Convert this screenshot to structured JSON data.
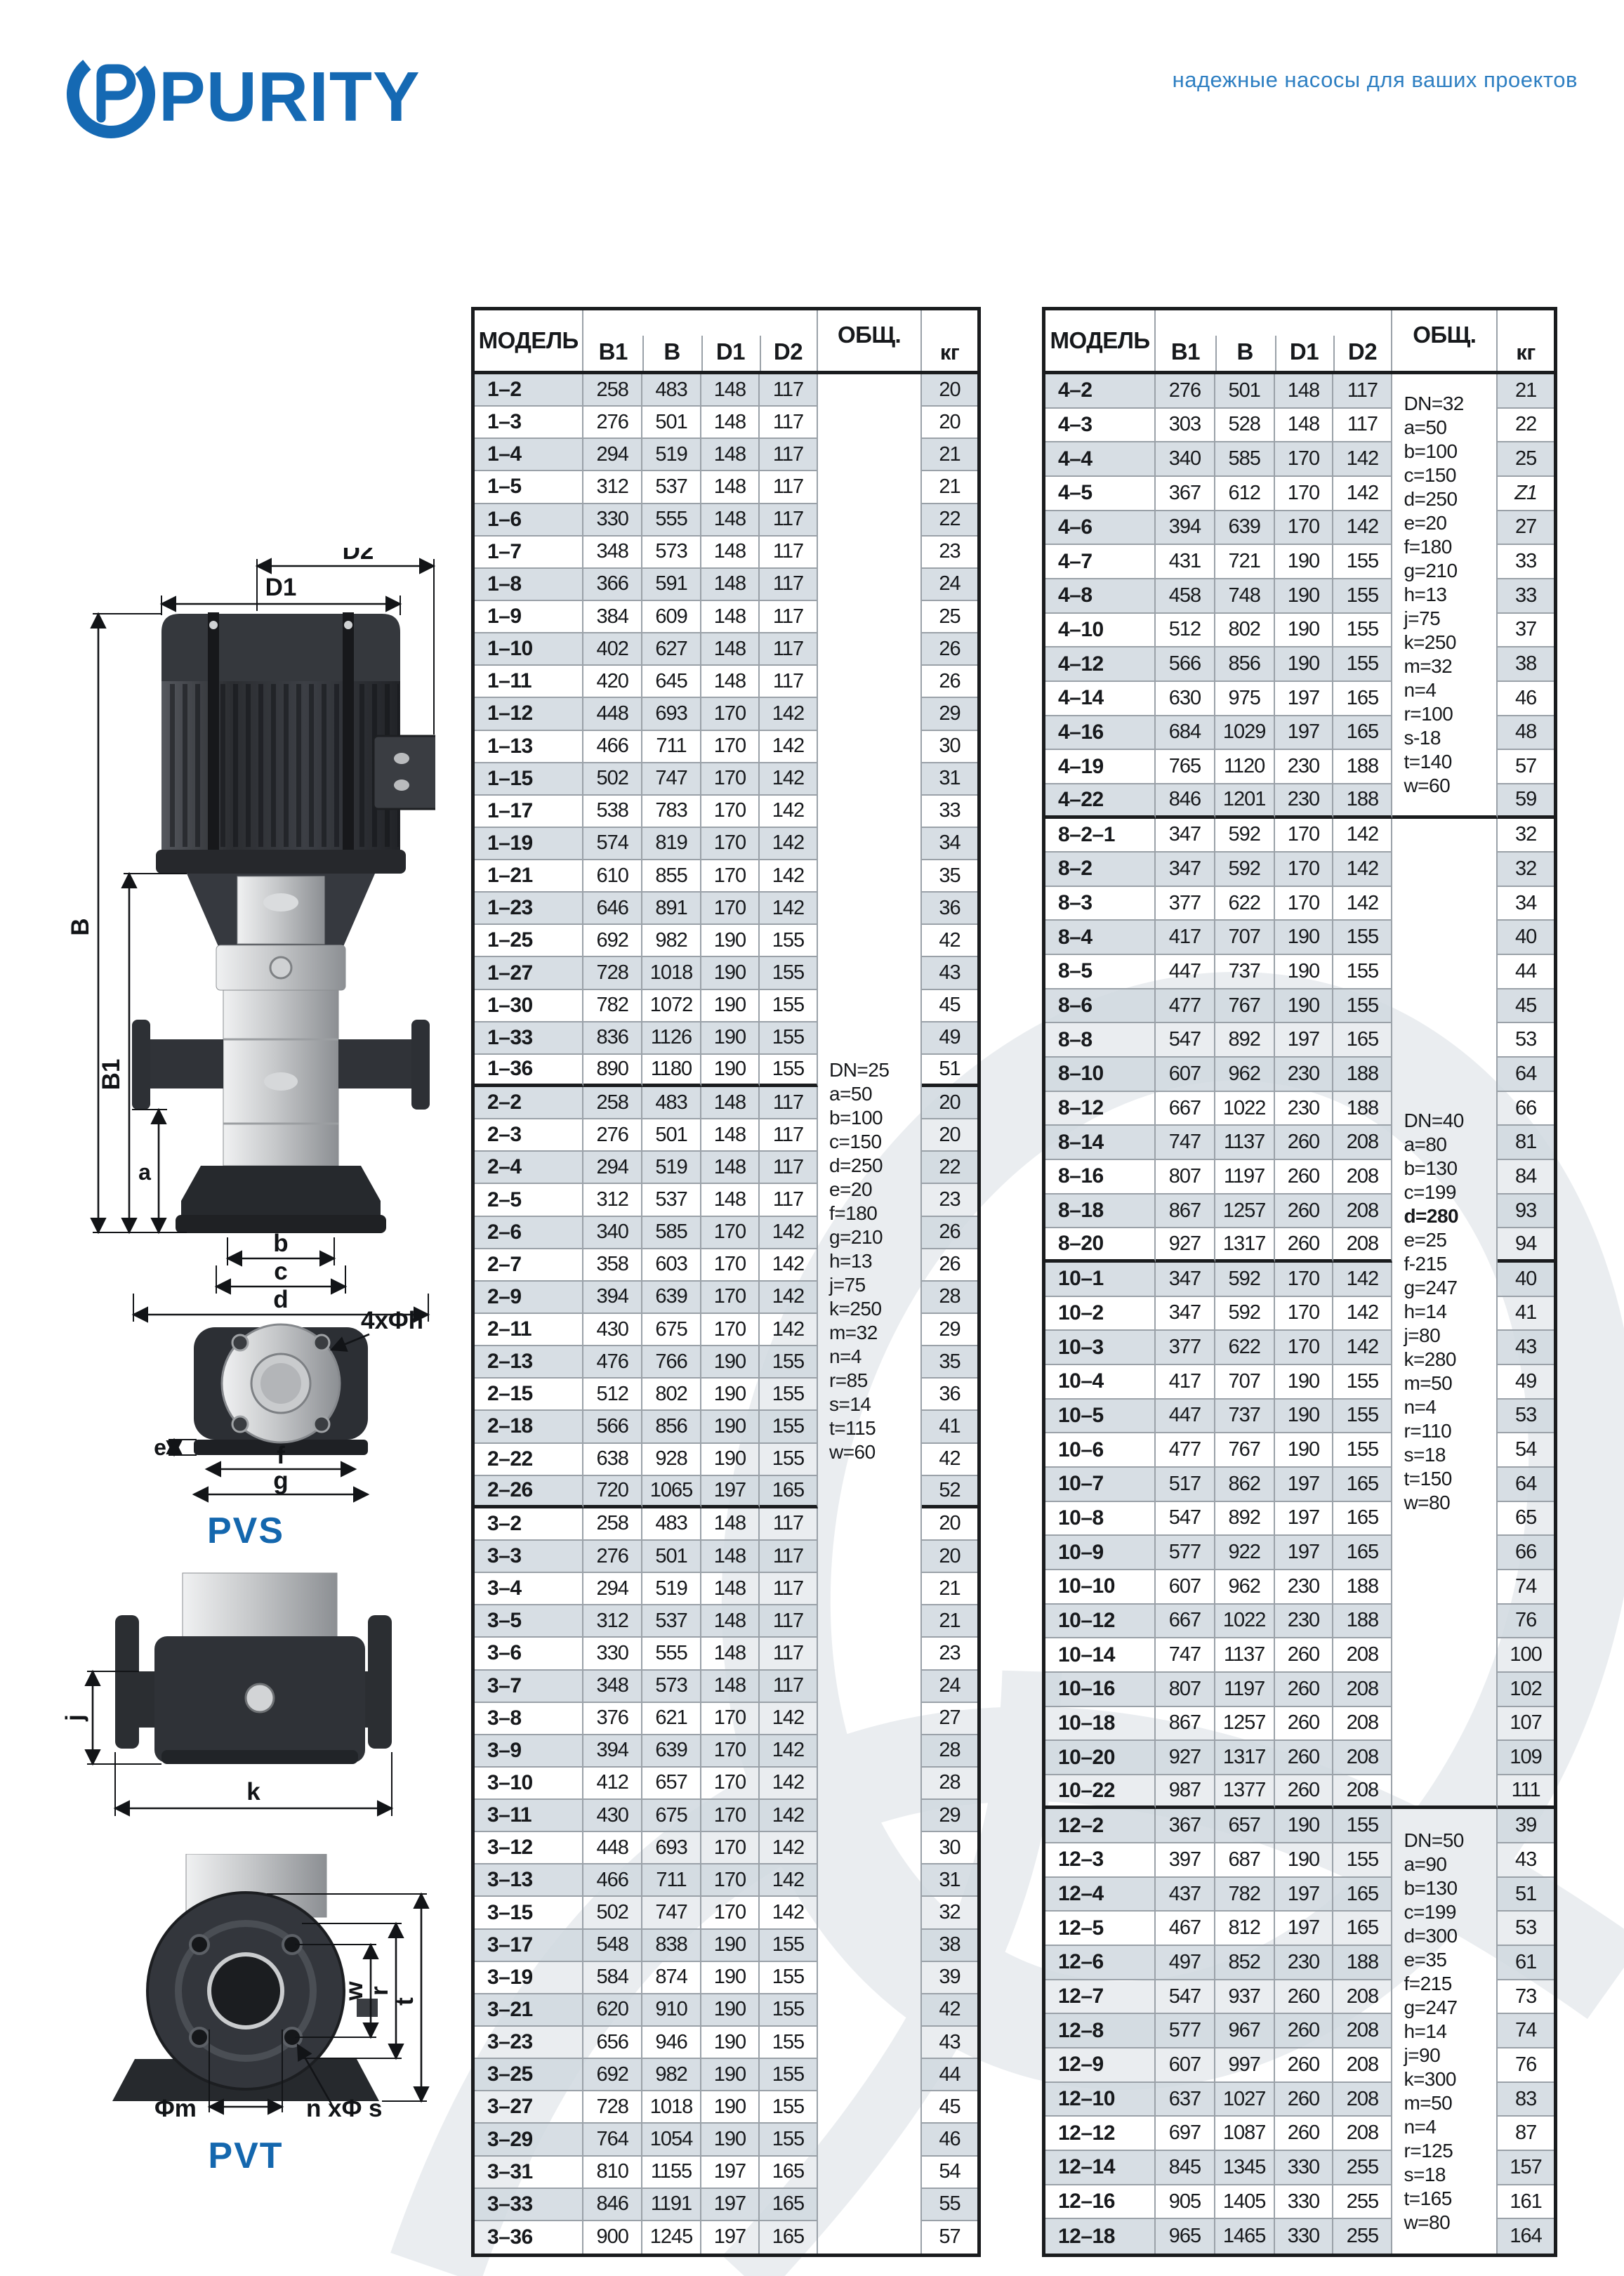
{
  "brand": {
    "logo_text": "PURITY",
    "tagline": "надежные насосы для ваших проектов",
    "blue": "#1569b3",
    "tagline_blue": "#2e7fc2"
  },
  "diagrams": {
    "pvs_label": "PVS",
    "pvt_label": "PVT",
    "dims": {
      "d1": "D1",
      "d2": "D2",
      "b_cap": "B",
      "b1": "B1",
      "a": "a",
      "b": "b",
      "c": "c",
      "d": "d",
      "e": "e",
      "f": "f",
      "g": "g",
      "holes": "4xΦh",
      "j": "j",
      "k": "k",
      "w": "w",
      "r": "r",
      "t": "t",
      "m": "Φm",
      "ns": "n xΦ s"
    }
  },
  "tables": [
    {
      "headers": {
        "model": "МОДЕЛЬ",
        "b1": "B1",
        "b": "B",
        "d1": "D1",
        "d2": "D2",
        "obsh": "ОБЩ.",
        "kg": "кг"
      },
      "italic_kg": [],
      "sections": [
        {
          "rows": [
            [
              "1–2",
              258,
              483,
              148,
              117,
              20
            ],
            [
              "1–3",
              276,
              501,
              148,
              117,
              20
            ],
            [
              "1–4",
              294,
              519,
              148,
              117,
              21
            ],
            [
              "1–5",
              312,
              537,
              148,
              117,
              21
            ],
            [
              "1–6",
              330,
              555,
              148,
              117,
              22
            ],
            [
              "1–7",
              348,
              573,
              148,
              117,
              23
            ],
            [
              "1–8",
              366,
              591,
              148,
              117,
              24
            ],
            [
              "1–9",
              384,
              609,
              148,
              117,
              25
            ],
            [
              "1–10",
              402,
              627,
              148,
              117,
              26
            ],
            [
              "1–11",
              420,
              645,
              148,
              117,
              26
            ],
            [
              "1–12",
              448,
              693,
              170,
              142,
              29
            ],
            [
              "1–13",
              466,
              711,
              170,
              142,
              30
            ],
            [
              "1–15",
              502,
              747,
              170,
              142,
              31
            ],
            [
              "1–17",
              538,
              783,
              170,
              142,
              33
            ],
            [
              "1–19",
              574,
              819,
              170,
              142,
              34
            ],
            [
              "1–21",
              610,
              855,
              170,
              142,
              35
            ],
            [
              "1–23",
              646,
              891,
              170,
              142,
              36
            ],
            [
              "1–25",
              692,
              982,
              190,
              155,
              42
            ],
            [
              "1–27",
              728,
              1018,
              190,
              155,
              43
            ],
            [
              "1–30",
              782,
              1072,
              190,
              155,
              45
            ],
            [
              "1–33",
              836,
              1126,
              190,
              155,
              49
            ],
            [
              "1–36",
              890,
              1180,
              190,
              155,
              51
            ]
          ]
        },
        {
          "rows": [
            [
              "2–2",
              258,
              483,
              148,
              117,
              20
            ],
            [
              "2–3",
              276,
              501,
              148,
              117,
              20
            ],
            [
              "2–4",
              294,
              519,
              148,
              117,
              22
            ],
            [
              "2–5",
              312,
              537,
              148,
              117,
              23
            ],
            [
              "2–6",
              340,
              585,
              170,
              142,
              26
            ],
            [
              "2–7",
              358,
              603,
              170,
              142,
              26
            ],
            [
              "2–9",
              394,
              639,
              170,
              142,
              28
            ],
            [
              "2–11",
              430,
              675,
              170,
              142,
              29
            ],
            [
              "2–13",
              476,
              766,
              190,
              155,
              35
            ],
            [
              "2–15",
              512,
              802,
              190,
              155,
              36
            ],
            [
              "2–18",
              566,
              856,
              190,
              155,
              41
            ],
            [
              "2–22",
              638,
              928,
              190,
              155,
              42
            ],
            [
              "2–26",
              720,
              1065,
              197,
              165,
              52
            ]
          ]
        },
        {
          "rows": [
            [
              "3–2",
              258,
              483,
              148,
              117,
              20
            ],
            [
              "3–3",
              276,
              501,
              148,
              117,
              20
            ],
            [
              "3–4",
              294,
              519,
              148,
              117,
              21
            ],
            [
              "3–5",
              312,
              537,
              148,
              117,
              21
            ],
            [
              "3–6",
              330,
              555,
              148,
              117,
              23
            ],
            [
              "3–7",
              348,
              573,
              148,
              117,
              24
            ],
            [
              "3–8",
              376,
              621,
              170,
              142,
              27
            ],
            [
              "3–9",
              394,
              639,
              170,
              142,
              28
            ],
            [
              "3–10",
              412,
              657,
              170,
              142,
              28
            ],
            [
              "3–11",
              430,
              675,
              170,
              142,
              29
            ],
            [
              "3–12",
              448,
              693,
              170,
              142,
              30
            ],
            [
              "3–13",
              466,
              711,
              170,
              142,
              31
            ],
            [
              "3–15",
              502,
              747,
              170,
              142,
              32
            ],
            [
              "3–17",
              548,
              838,
              190,
              155,
              38
            ],
            [
              "3–19",
              584,
              874,
              190,
              155,
              39
            ],
            [
              "3–21",
              620,
              910,
              190,
              155,
              42
            ],
            [
              "3–23",
              656,
              946,
              190,
              155,
              43
            ],
            [
              "3–25",
              692,
              982,
              190,
              155,
              44
            ],
            [
              "3–27",
              728,
              1018,
              190,
              155,
              45
            ],
            [
              "3–29",
              764,
              1054,
              190,
              155,
              46
            ],
            [
              "3–31",
              810,
              1155,
              197,
              165,
              54
            ],
            [
              "3–33",
              846,
              1191,
              197,
              165,
              55
            ],
            [
              "3–36",
              900,
              1245,
              197,
              165,
              57
            ]
          ]
        }
      ],
      "spec_blocks": [
        {
          "row_start": 1,
          "row_end": 58,
          "center_abs": true,
          "thick_bottom": false,
          "bold": [],
          "lines": [
            "DN=25",
            "a=50",
            "b=100",
            "c=150",
            "d=250",
            "e=20",
            "f=180",
            "g=210",
            "h=13",
            "j=75",
            "k=250",
            "m=32",
            "n=4",
            "r=85",
            "s=14",
            "t=115",
            "w=60"
          ]
        }
      ]
    },
    {
      "headers": {
        "model": "МОДЕЛЬ",
        "b1": "B1",
        "b": "B",
        "d1": "D1",
        "d2": "D2",
        "obsh": "ОБЩ.",
        "kg": "кг"
      },
      "italic_kg": [
        "4–5"
      ],
      "sections": [
        {
          "rows": [
            [
              "4–2",
              276,
              501,
              148,
              117,
              "21"
            ],
            [
              "4–3",
              303,
              528,
              148,
              117,
              "22"
            ],
            [
              "4–4",
              340,
              585,
              170,
              142,
              "25"
            ],
            [
              "4–5",
              367,
              612,
              170,
              142,
              "Z1"
            ],
            [
              "4–6",
              394,
              639,
              170,
              142,
              "27"
            ],
            [
              "4–7",
              431,
              721,
              190,
              155,
              "33"
            ],
            [
              "4–8",
              458,
              748,
              190,
              155,
              "33"
            ],
            [
              "4–10",
              512,
              802,
              190,
              155,
              "37"
            ],
            [
              "4–12",
              566,
              856,
              190,
              155,
              "38"
            ],
            [
              "4–14",
              630,
              975,
              197,
              165,
              "46"
            ],
            [
              "4–16",
              684,
              1029,
              197,
              165,
              "48"
            ],
            [
              "4–19",
              765,
              1120,
              230,
              188,
              "57"
            ],
            [
              "4–22",
              846,
              1201,
              230,
              188,
              "59"
            ]
          ]
        },
        {
          "rows": [
            [
              "8–2–1",
              347,
              592,
              170,
              142,
              32
            ],
            [
              "8–2",
              347,
              592,
              170,
              142,
              32
            ],
            [
              "8–3",
              377,
              622,
              170,
              142,
              34
            ],
            [
              "8–4",
              417,
              707,
              190,
              155,
              40
            ],
            [
              "8–5",
              447,
              737,
              190,
              155,
              44
            ],
            [
              "8–6",
              477,
              767,
              190,
              155,
              45
            ],
            [
              "8–8",
              547,
              892,
              197,
              165,
              53
            ],
            [
              "8–10",
              607,
              962,
              230,
              188,
              64
            ],
            [
              "8–12",
              667,
              1022,
              230,
              188,
              66
            ],
            [
              "8–14",
              747,
              1137,
              260,
              208,
              81
            ],
            [
              "8–16",
              807,
              1197,
              260,
              208,
              84
            ],
            [
              "8–18",
              867,
              1257,
              260,
              208,
              93
            ],
            [
              "8–20",
              927,
              1317,
              260,
              208,
              94
            ]
          ]
        },
        {
          "rows": [
            [
              "10–1",
              347,
              592,
              170,
              142,
              40
            ],
            [
              "10–2",
              347,
              592,
              170,
              142,
              41
            ],
            [
              "10–3",
              377,
              622,
              170,
              142,
              43
            ],
            [
              "10–4",
              417,
              707,
              190,
              155,
              49
            ],
            [
              "10–5",
              447,
              737,
              190,
              155,
              53
            ],
            [
              "10–6",
              477,
              767,
              190,
              155,
              54
            ],
            [
              "10–7",
              517,
              862,
              197,
              165,
              64
            ],
            [
              "10–8",
              547,
              892,
              197,
              165,
              65
            ],
            [
              "10–9",
              577,
              922,
              197,
              165,
              66
            ],
            [
              "10–10",
              607,
              962,
              230,
              188,
              74
            ],
            [
              "10–12",
              667,
              1022,
              230,
              188,
              76
            ],
            [
              "10–14",
              747,
              1137,
              260,
              208,
              100
            ],
            [
              "10–16",
              807,
              1197,
              260,
              208,
              102
            ],
            [
              "10–18",
              867,
              1257,
              260,
              208,
              107
            ],
            [
              "10–20",
              927,
              1317,
              260,
              208,
              109
            ],
            [
              "10–22",
              987,
              1377,
              260,
              208,
              111
            ]
          ]
        },
        {
          "rows": [
            [
              "12–2",
              367,
              657,
              190,
              155,
              39
            ],
            [
              "12–3",
              397,
              687,
              190,
              155,
              43
            ],
            [
              "12–4",
              437,
              782,
              197,
              165,
              51
            ],
            [
              "12–5",
              467,
              812,
              197,
              165,
              53
            ],
            [
              "12–6",
              497,
              852,
              230,
              188,
              61
            ],
            [
              "12–7",
              547,
              937,
              260,
              208,
              73
            ],
            [
              "12–8",
              577,
              967,
              260,
              208,
              74
            ],
            [
              "12–9",
              607,
              997,
              260,
              208,
              76
            ],
            [
              "12–10",
              637,
              1027,
              260,
              208,
              83
            ],
            [
              "12–12",
              697,
              1087,
              260,
              208,
              87
            ],
            [
              "12–14",
              845,
              1345,
              330,
              255,
              157
            ],
            [
              "12–16",
              905,
              1405,
              330,
              255,
              161
            ],
            [
              "12–18",
              965,
              1465,
              330,
              255,
              164
            ]
          ]
        }
      ],
      "spec_blocks": [
        {
          "row_start": 1,
          "row_end": 13,
          "thick_bottom": true,
          "bold": [],
          "lines": [
            "DN=32",
            "a=50",
            "b=100",
            "c=150",
            "d=250",
            "e=20",
            "f=180",
            "g=210",
            "h=13",
            "j=75",
            "k=250",
            "m=32",
            "n=4",
            "r=100",
            "s-18",
            "t=140",
            "w=60"
          ]
        },
        {
          "row_start": 14,
          "row_end": 42,
          "thick_bottom": true,
          "bold": [
            "d=280"
          ],
          "lines": [
            "DN=40",
            "a=80",
            "b=130",
            "c=199",
            "d=280",
            "e=25",
            "f-215",
            "g=247",
            "h=14",
            "j=80",
            "k=280",
            "m=50",
            "n=4",
            "r=110",
            "s=18",
            "t=150",
            "w=80"
          ]
        },
        {
          "row_start": 43,
          "row_end": 55,
          "thick_bottom": false,
          "bold": [],
          "lines": [
            "DN=50",
            "a=90",
            "b=130",
            "c=199",
            "d=300",
            "e=35",
            "f=215",
            "g=247",
            "h=14",
            "j=90",
            "k=300",
            "m=50",
            "n=4",
            "r=125",
            "s=18",
            "t=165",
            "w=80"
          ]
        }
      ]
    }
  ]
}
